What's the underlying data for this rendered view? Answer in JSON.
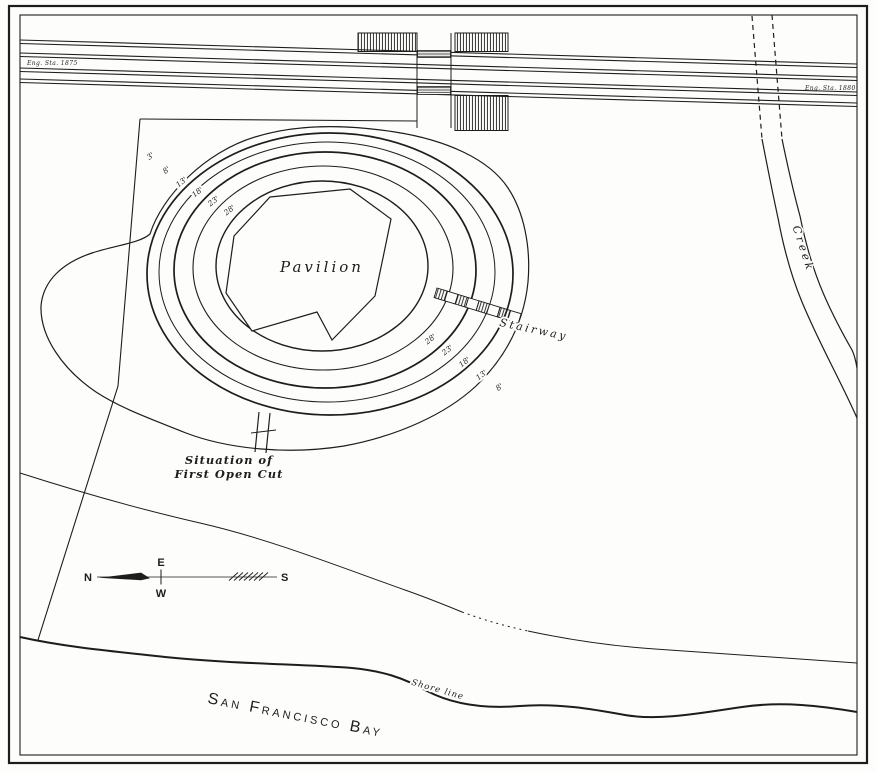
{
  "map": {
    "colors": {
      "ink": "#1d1d1d",
      "paper": "#fdfdfb"
    },
    "railroad": {
      "station_label_left": "Eng. Sta. 1875",
      "station_label_right": "Eng. Sta. 1880"
    },
    "mound": {
      "pavilion_label": "Pavilion",
      "stairway_label": "Stairway",
      "contour_labels_upper": [
        "3'",
        "8'",
        "13'",
        "18'",
        "23'",
        "28'"
      ],
      "contour_labels_lower": [
        "28'",
        "23'",
        "18'",
        "13'",
        "8'"
      ]
    },
    "excavation": {
      "label_line1": "Situation of",
      "label_line2": "First Open Cut"
    },
    "compass": {
      "north": "N",
      "east": "E",
      "south": "S",
      "west": "W"
    },
    "water": {
      "creek_label": "Creek",
      "shoreline_label": "Shore line",
      "bay_label": "San Francisco Bay"
    }
  }
}
